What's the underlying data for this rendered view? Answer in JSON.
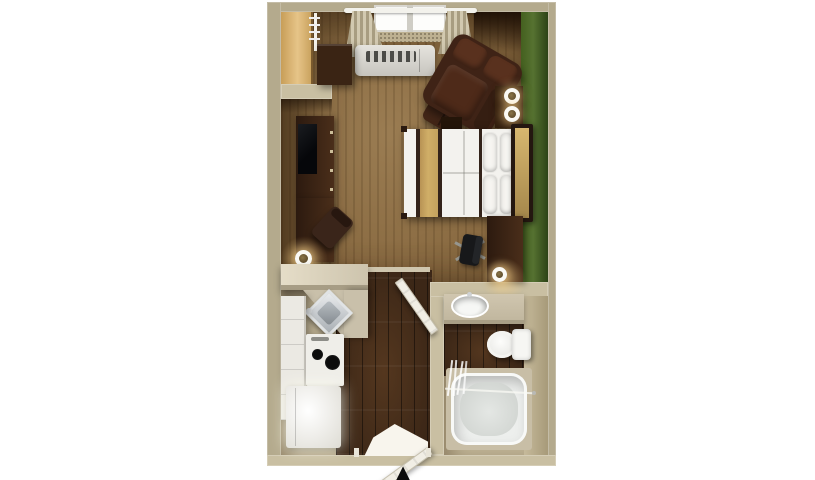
{
  "scene": {
    "kind": "3d-rendered-floor-plan",
    "view": "top-down",
    "unit_type": "studio-suite"
  },
  "palette": {
    "background": "#ffffff",
    "wall": "#b4aa8d",
    "wall_light": "#c9bfa2",
    "carpet": "#8a6b42",
    "wood_floor": "#3c2717",
    "green_wall": "#567231",
    "counter": "#cdc4ad",
    "dark_wood": "#4a2e1a",
    "darker_wood": "#2c1a0f",
    "leather": "#4f2a1b",
    "linen": "#f3f2ee",
    "gold": "#d0ae67",
    "fixture_white": "#f3f4f1",
    "sill": "#bdb091",
    "tv": "#0b0c0e"
  },
  "rooms": [
    {
      "name": "living-sleeping-area",
      "floor": "carpet",
      "features": [
        "window",
        "curtains",
        "ac-unit",
        "green-accent-wall"
      ]
    },
    {
      "name": "kitchen",
      "floor": "hardwood",
      "features": [
        "breakfast-bar",
        "sink",
        "stove",
        "refrigerator",
        "cabinets"
      ]
    },
    {
      "name": "bathroom",
      "floor": "hardwood",
      "features": [
        "vanity-sink",
        "toilet",
        "bathtub",
        "shower-curtain"
      ]
    },
    {
      "name": "entry-hall",
      "floor": "hardwood",
      "features": [
        "entrance-door"
      ]
    }
  ],
  "furniture": {
    "living_sleeping": [
      "wardrobe-closet",
      "luggage-shelf",
      "tv-console",
      "flat-tv",
      "side-table",
      "table-lamp",
      "dining-chair",
      "armchair",
      "ottoman",
      "nightstand",
      "twin-lamps",
      "queen-bed",
      "gold-bed-runner",
      "pillows",
      "headboard",
      "desk",
      "office-chair",
      "desk-lamp"
    ],
    "kitchen": [
      "refrigerator",
      "two-burner-stove",
      "stainless-sink",
      "upper-lower-cabinets",
      "counter"
    ],
    "bathroom": [
      "vanity-counter",
      "oval-sink",
      "toilet",
      "bathtub",
      "shower-curtain-rod",
      "bathroom-door"
    ]
  },
  "annotations": {
    "entrance_arrow": "▲"
  }
}
